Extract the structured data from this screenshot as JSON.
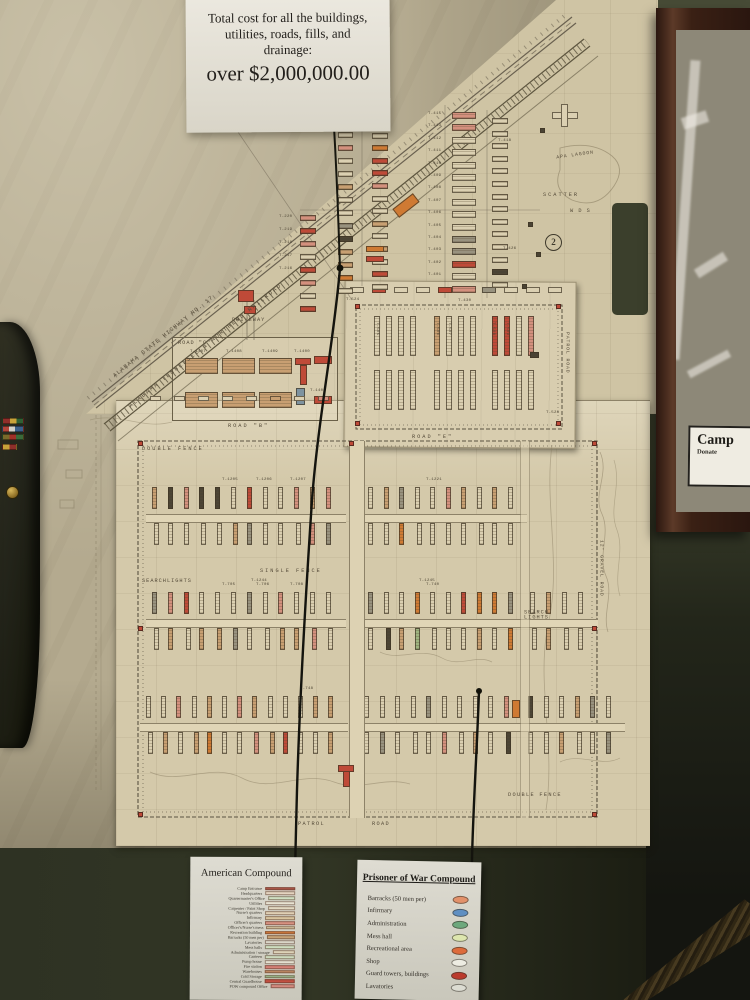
{
  "top_sign": {
    "line1": "Total cost for all the buildings,",
    "line2": "utilities, roads, fills, and",
    "line3": "drainage:",
    "amount": "over $2,000,000.00"
  },
  "framed_display": {
    "card_title": "Camp",
    "card_subtitle": "Donate"
  },
  "map": {
    "labels": {
      "highway": "ALABAMA STATE HIGHWAY NO. 17",
      "railroad": "ALABAMA TENNESSEE & NORTHERN RAILROAD",
      "driveway": "DRIVEWAY",
      "scatter": "SCATTER",
      "wds": "W D S",
      "lagoon": "APA LAGOON",
      "circled_number": "2",
      "road_c": "ROAD \"C\"",
      "road_b": "ROAD \"B\"",
      "road_e": "ROAD \"E\"",
      "patrol_road": "PATROL ROAD",
      "double_fence_top": "DOUBLE  FENCE",
      "single_fence": "SINGLE  FENCE",
      "searchlights_left": "SEARCHLIGHTS",
      "searchlights_right": "SEARCH LIGHTS",
      "gravel_road": "12' GRAVEL ROAD",
      "double_fence_bottom": "DOUBLE FENCE",
      "patrol_bottom": "PATROL",
      "road_bottom": "ROAD"
    },
    "buildings": {
      "upper_stack": [
        "T-415",
        "T-413",
        "T-412",
        "T-411",
        "T-410",
        "T-409",
        "T-408",
        "T-407",
        "T-406",
        "T-405",
        "T-404",
        "T-403",
        "T-402",
        "T-401"
      ],
      "upper_side": [
        "T-418",
        "T-426",
        "T-430"
      ],
      "upper_left": [
        "T-220",
        "T-219",
        "T-218",
        "T-217",
        "T-216"
      ],
      "strip": [
        "T-1407",
        "T-1408",
        "T-1409",
        "T-1400",
        "T-1401"
      ],
      "inset": [
        "T-505",
        "T-506",
        "T-507",
        "T-508",
        "T-509",
        "T-524",
        "T-528"
      ],
      "big": [
        "T-1205",
        "T-1206",
        "T-1207",
        "T-1221",
        "T-1244",
        "T-1245",
        "T-705",
        "T-706",
        "T-708",
        "T-740",
        "T-748"
      ]
    },
    "palette": {
      "cream": "#dbd0b2",
      "tan": "#c89f72",
      "gray": "#98927f",
      "pink": "#d4907e",
      "orange": "#cf7a33",
      "red": "#bf4a38",
      "green": "#9eb37f",
      "dark": "#4a4334"
    }
  },
  "legend_american": {
    "title": "American Compound",
    "items": [
      {
        "label": "Camp Entrance",
        "color": "#b0584a"
      },
      {
        "label": "Headquarters",
        "color": "#e4d4c0"
      },
      {
        "label": "Quartermaster's Office",
        "color": "#cfdfc2"
      },
      {
        "label": "Utilities",
        "color": "#e8e3d2"
      },
      {
        "label": "Carpenter / Paint Shop",
        "color": "#e2d9c2"
      },
      {
        "label": "Nurse's quarters",
        "color": "#e0d0b4"
      },
      {
        "label": "Infirmary",
        "color": "#d8c49e"
      },
      {
        "label": "Officer's quarters",
        "color": "#d79181"
      },
      {
        "label": "Officer's/Nurse's mess",
        "color": "#d6c49f"
      },
      {
        "label": "Recreation building",
        "color": "#d37b3c"
      },
      {
        "label": "Barracks (50 men per)",
        "color": "#c6a276"
      },
      {
        "label": "Lavatories",
        "color": "#dad6c8"
      },
      {
        "label": "Mess halls",
        "color": "#cedec0"
      },
      {
        "label": "Administration / storage",
        "color": "#ddd3b8"
      },
      {
        "label": "Canteen",
        "color": "#ccdabd"
      },
      {
        "label": "Pump house",
        "color": "#e4e0d0"
      },
      {
        "label": "Fire station",
        "color": "#d58076"
      },
      {
        "label": "Warehouses",
        "color": "#c48d66"
      },
      {
        "label": "Cold Storage",
        "color": "#9cba8c"
      },
      {
        "label": "Central Guardhouse",
        "color": "#c24f41"
      },
      {
        "label": "POW compound Office",
        "color": "#d4897e"
      }
    ]
  },
  "legend_pow": {
    "title": "Prisoner of War Compound",
    "items": [
      {
        "label": "Barracks (50 men per)",
        "color": "#e2916a"
      },
      {
        "label": "Infirmary",
        "color": "#5f8fc2"
      },
      {
        "label": "Administration",
        "color": "#6da87d"
      },
      {
        "label": "Mess hall",
        "color": "#dde6ae"
      },
      {
        "label": "Recreational area",
        "color": "#dd6b3b"
      },
      {
        "label": "Shop",
        "color": "#edece2"
      },
      {
        "label": "Guard towers, buildings",
        "color": "#bb3a2c"
      },
      {
        "label": "Lavatories",
        "color": "#dcdcd2"
      }
    ]
  }
}
